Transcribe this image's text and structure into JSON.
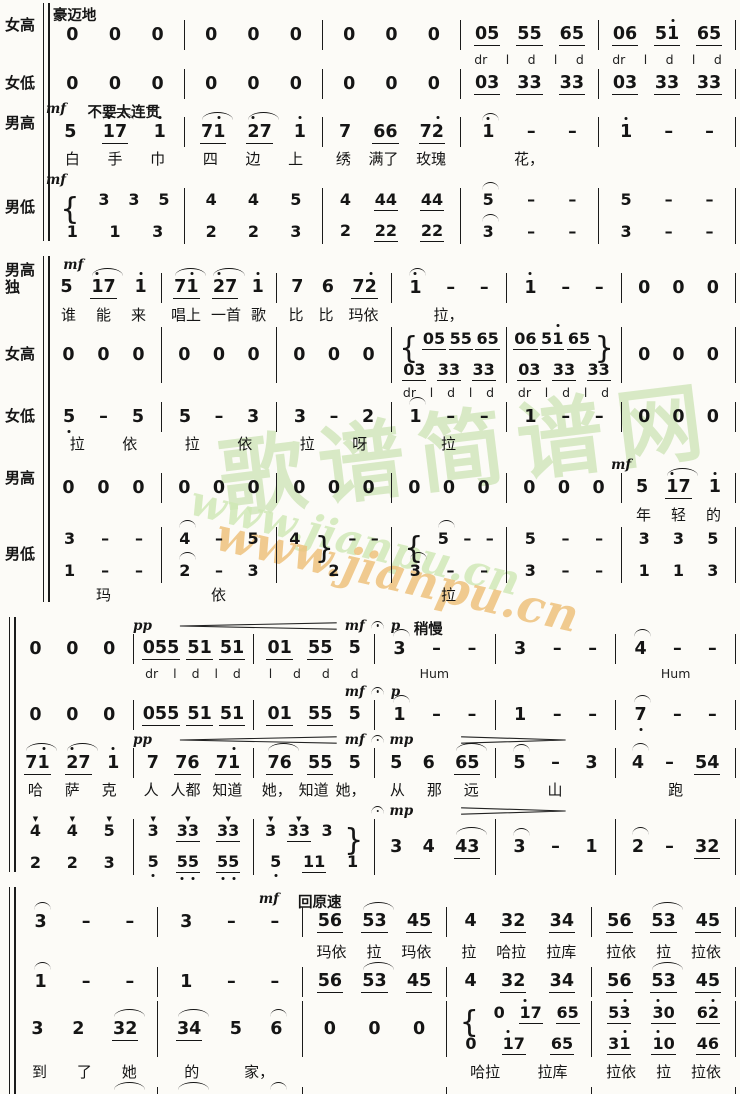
{
  "watermark": {
    "seal_text": "歌谱简谱网",
    "url": "www.jianpu.cn",
    "seal_color": "#bcdb9e",
    "url_green_color": "#cfe8b4",
    "url_orange_color": "#eec27e"
  },
  "systems": [
    {
      "cols": 5,
      "rows": [
        {
          "n": "soprano-notes",
          "label": "女高",
          "type": "notes",
          "marks": [
            {
              "m": 0.05,
              "t": "豪迈地",
              "c": "tempo"
            }
          ],
          "cells": [
            "0 0 0",
            "0 0 0",
            "0 0 0",
            "_05_ _55_ _65_",
            "_06_ _51'_ _65_"
          ]
        },
        {
          "n": "solfege",
          "type": "solfege",
          "cells": [
            "",
            "",
            "",
            "dr l d l d",
            "dr l d l d"
          ]
        },
        {
          "n": "alto-notes",
          "label": "女低",
          "type": "notes",
          "cells": [
            "0 0 0",
            "0 0 0",
            "0 0 0",
            "_03_ _33_ _33_",
            "_03_ _33_ _33_"
          ]
        },
        {
          "n": "tenor-notes",
          "label": "男高",
          "type": "notes",
          "marks": [
            {
              "m": 0.0,
              "t": "mf",
              "c": "dyn"
            },
            {
              "m": 0.3,
              "t": "不要太连贯",
              "c": "tempo"
            }
          ],
          "cells": [
            "5 ⌒_1'7_ 1'",
            "⌒_71'_ ⌒_2'7_ 1'",
            "7 _66_ _72'_",
            "⌒1' - -",
            "1' - -"
          ]
        },
        {
          "n": "tenor-lyrics",
          "type": "lyrics",
          "cells": [
            "白 手 巾",
            "四 边 上",
            "绣 满了 玫瑰",
            "花，",
            ""
          ]
        },
        {
          "n": "bass-notes",
          "label": "男低",
          "type": "notes",
          "marks": [
            {
              "m": 0.0,
              "t": "mf",
              "c": "dyn"
            }
          ],
          "cells": [
            "{ 3 3 5//1 1 3",
            "4 4 5//2 2 3",
            "4 _44_ _44_//2 _22_ _22_",
            "⌒5 - -//⌒3 - -",
            "5 - -//3 - -"
          ]
        }
      ]
    },
    {
      "cols": 6,
      "rows": [
        {
          "n": "tenor-solo-notes",
          "label": "男高\n独",
          "type": "notes",
          "marks": [
            {
              "m": 0.15,
              "t": "mf",
              "c": "dyn"
            }
          ],
          "cells": [
            "5 ⌒_1'7_ 1'",
            "⌒_71'_ ⌒_2'7_ 1'",
            "7 6 _72'_",
            "⌒1' - -",
            "1' - -",
            "0 0 0"
          ]
        },
        {
          "n": "tenor-solo-lyrics",
          "type": "lyrics",
          "cells": [
            "谁 能 来",
            "唱上 一首 歌",
            "比 比 玛依",
            "拉，",
            "",
            ""
          ]
        },
        {
          "n": "soprano-notes",
          "label": "女高",
          "type": "notes",
          "cells": [
            "0 0 0",
            "0 0 0",
            "0 0 0",
            "{ _05_ _55_ _65_//_03_ _33_ _33_",
            "_06_ _51'_ _65_ }//_03_ _33_ _33_",
            "0 0 0"
          ]
        },
        {
          "n": "solfege",
          "type": "solfege",
          "cells": [
            "",
            "",
            "",
            "dr l d l d",
            "dr l d l d",
            ""
          ]
        },
        {
          "n": "alto-notes",
          "label": "女低",
          "type": "notes",
          "cells": [
            "5, - 5",
            "5 - 3",
            "3 - 2",
            "⌒1 - -",
            "1 - -",
            "0 0 0"
          ]
        },
        {
          "n": "alto-lyrics",
          "type": "lyrics",
          "cells": [
            "拉 依",
            "拉 依",
            "拉 呀",
            "拉",
            "",
            ""
          ]
        },
        {
          "n": "tenor-notes",
          "label": "男高",
          "type": "notes",
          "marks": [
            {
              "m": 4.9,
              "t": "mf",
              "c": "dyn"
            }
          ],
          "cells": [
            "0 0 0",
            "0 0 0",
            "0 0 0",
            "0 0 0",
            "0 0 0",
            "5 ⌒_1'7_ 1'"
          ]
        },
        {
          "n": "tenor-lyrics",
          "type": "lyrics",
          "cells": [
            "",
            "",
            "",
            "",
            "",
            "年 轻 的"
          ]
        },
        {
          "n": "bass-notes",
          "label": "男低",
          "type": "notes",
          "cells": [
            "3 - -//1 - -",
            "⌒4 - 5//⌒2 - 3",
            "4 } - -//2",
            "{ ⌒5 - -//⌒3 - -",
            "5 - -//3 - -",
            "3 3 5//1 1 3"
          ]
        },
        {
          "n": "bass-lyrics",
          "type": "lyrics",
          "cells": [
            "玛",
            "依",
            "",
            "拉",
            "",
            ""
          ]
        }
      ]
    },
    {
      "cols": 6,
      "rows": [
        {
          "n": "soprano-notes",
          "type": "notes",
          "marks": [
            {
              "m": 1.0,
              "t": "pp",
              "c": "dyn"
            },
            {
              "m": 1.35,
              "s": 1.35,
              "c": "cresc"
            },
            {
              "m": 2.75,
              "t": "mf",
              "c": "dyn"
            },
            {
              "m": 2.97,
              "t": "⌒",
              "c": "ferm"
            },
            {
              "m": 3.13,
              "t": "p",
              "c": "dyn"
            },
            {
              "m": 3.32,
              "t": "稍慢",
              "c": "tempo"
            }
          ],
          "cells": [
            "0 0 0",
            "_055_ _51_ _51_",
            "_01_ _55_ 5",
            "⌒3 - -",
            "3 - -",
            "⌒4 - -"
          ]
        },
        {
          "n": "solfege-hum",
          "type": "solfege",
          "cells": [
            "",
            "dr l d l d",
            "l d d d",
            "Hum",
            "",
            "Hum"
          ]
        },
        {
          "n": "alto-notes",
          "type": "notes",
          "marks": [
            {
              "m": 2.75,
              "t": "mf",
              "c": "dyn"
            },
            {
              "m": 2.97,
              "t": "⌒",
              "c": "ferm"
            },
            {
              "m": 3.13,
              "t": "p",
              "c": "dyn"
            }
          ],
          "cells": [
            "0 0 0",
            "_055_ _51_ _51_",
            "_01_ _55_ 5",
            "⌒1 - -",
            "1 - -",
            "⌒7, - -"
          ]
        },
        {
          "n": "tenor-notes",
          "type": "notes",
          "marks": [
            {
              "m": 1.0,
              "t": "pp",
              "c": "dyn"
            },
            {
              "m": 1.35,
              "s": 1.35,
              "c": "cresc"
            },
            {
              "m": 2.75,
              "t": "mf",
              "c": "dyn"
            },
            {
              "m": 2.97,
              "t": "⌒",
              "c": "ferm"
            },
            {
              "m": 3.12,
              "t": "mp",
              "c": "dyn"
            },
            {
              "m": 3.7,
              "s": 0.9,
              "c": "decresc"
            }
          ],
          "cells": [
            "⌒_71'_ ⌒_2'7_ 1'",
            "7 _76_ _71'_",
            "⌒_76_ _55_ 5",
            "5 6 ⌒_65_",
            "⌒5 - 3",
            "⌒4 - _54_"
          ]
        },
        {
          "n": "tenor-lyrics",
          "type": "lyrics",
          "cells": [
            "哈 萨 克",
            "人 人都 知道",
            "她， 知道 她，",
            "从 那 远",
            "山",
            "跑"
          ]
        },
        {
          "n": "bass-notes",
          "type": "notes",
          "marks": [
            {
              "m": 2.97,
              "t": "⌒",
              "c": "ferm"
            },
            {
              "m": 3.12,
              "t": "mp",
              "c": "dyn"
            },
            {
              "m": 3.7,
              "s": 0.9,
              "c": "decresc"
            }
          ],
          "cells": [
            "!4 !4 !5//2 2 3",
            "!3 !_33_ !_33_//5, _5,5,_ _5,5,_",
            "!3 !_33_ 3 }//5, _11_ 1",
            "3 4 ⌒_43_",
            "⌒3 - 1",
            "⌒2 - _32_"
          ]
        }
      ]
    },
    {
      "cols": 5,
      "rows": [
        {
          "n": "soprano-notes",
          "type": "notes",
          "marks": [
            {
              "m": 1.7,
              "t": "mf",
              "c": "dyn"
            },
            {
              "m": 1.97,
              "t": "回原速",
              "c": "tempo"
            }
          ],
          "cells": [
            "⌒3 - -",
            "3 - -",
            "_56_ ⌒_53_ _45_",
            "4 _32_ _34_",
            "_56_ ⌒_53_ _45_"
          ]
        },
        {
          "n": "soprano-lyrics",
          "type": "lyrics",
          "cells": [
            "",
            "",
            "玛依 拉 玛依",
            "拉 哈拉 拉库",
            "拉依 拉 拉依"
          ]
        },
        {
          "n": "alto-notes",
          "type": "notes",
          "cells": [
            "⌒1 - -",
            "1 - -",
            "_56_ ⌒_53_ _45_",
            "4 _32_ _34_",
            "_56_ ⌒_53_ _45_"
          ]
        },
        {
          "n": "tenor-notes",
          "type": "notes",
          "cells": [
            "3 2 ⌒_32_",
            "⌒_34_ 5 ⌒6",
            "0 0 0",
            "{ 0 _1'7_ _65_//0 _1'7_ _65_",
            "_53'_ _3'0_ _62'_//_31'_ _1'0_ _46_"
          ]
        },
        {
          "n": "tenor-lyrics",
          "type": "lyrics",
          "cells": [
            "到 了 她",
            "的 家，",
            "",
            "哈拉 拉库",
            "拉依 拉 拉依"
          ]
        },
        {
          "n": "bass-notes",
          "type": "notes",
          "cells": [
            "1 7, ⌒_17,_",
            "⌒_12_ 3 ⌒4",
            "0 0 0",
            "0 _33_ _33_",
            "_5,3_ _30_ _6,2_"
          ]
        }
      ]
    }
  ]
}
